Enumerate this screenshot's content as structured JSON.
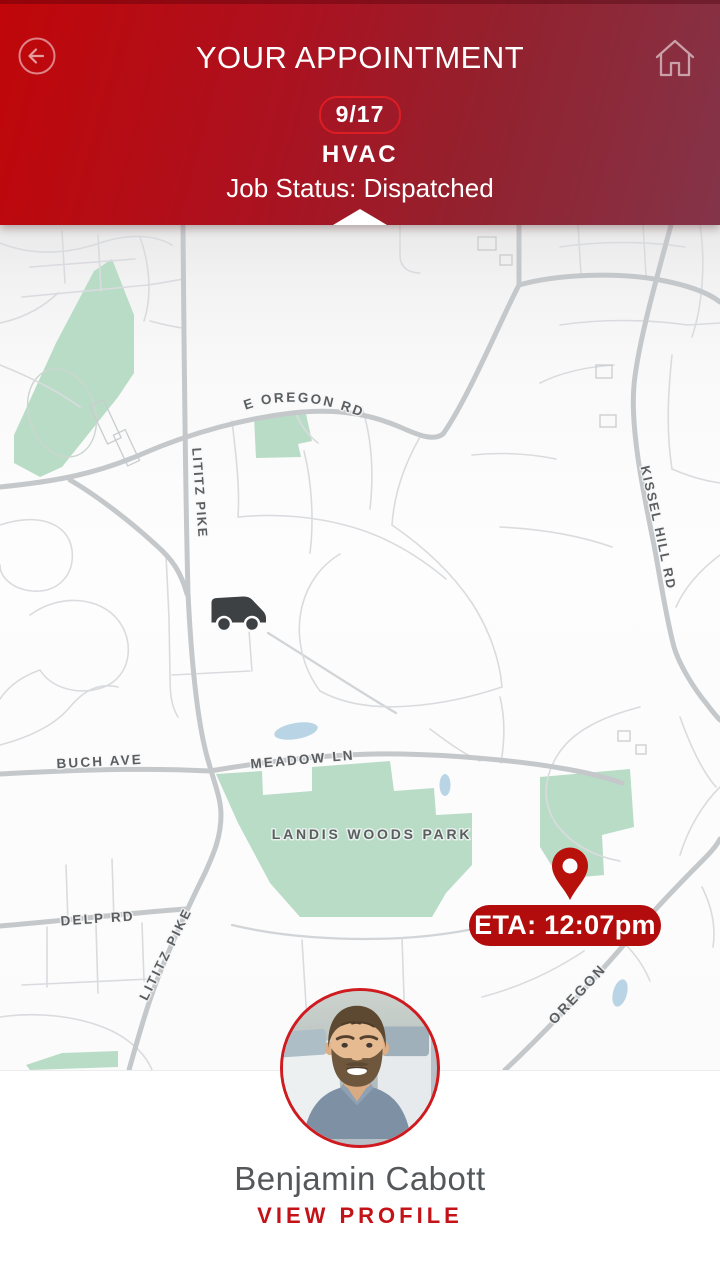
{
  "header": {
    "title": "YOUR APPOINTMENT",
    "date_badge": "9/17",
    "service_type": "HVAC",
    "job_status": "Job Status: Dispatched",
    "icons": {
      "back": "back-arrow-circle",
      "home": "home-outline"
    },
    "colors": {
      "gradient_left": "#c00609",
      "gradient_right": "#843449",
      "badge_border": "#dd1d24"
    }
  },
  "map": {
    "road_labels": {
      "e_oregon": "E OREGON RD",
      "lititz_top": "LITITZ PIKE",
      "kissel_hill": "KISSEL HILL RD",
      "buch": "BUCH AVE",
      "meadow": "MEADOW LN",
      "landis_park": "LANDIS WOODS PARK",
      "delp": "DELP RD",
      "lititz_bottom": "LITITZ PIKE",
      "oregon": "OREGON"
    },
    "eta_badge": "ETA: 12:07pm",
    "markers": {
      "truck": "technician-truck",
      "pin": "destination-pin"
    },
    "colors": {
      "park": "#b9dcc7",
      "water": "#b9d4e4",
      "major_road": "#c5c8ca",
      "minor_road": "#d9dbde",
      "label": "#5a5e61",
      "eta_bg": "#b20d0c",
      "pin": "#b8100b",
      "truck": "#3d4144"
    }
  },
  "technician": {
    "name": "Benjamin Cabott",
    "profile_link": "VIEW PROFILE"
  }
}
